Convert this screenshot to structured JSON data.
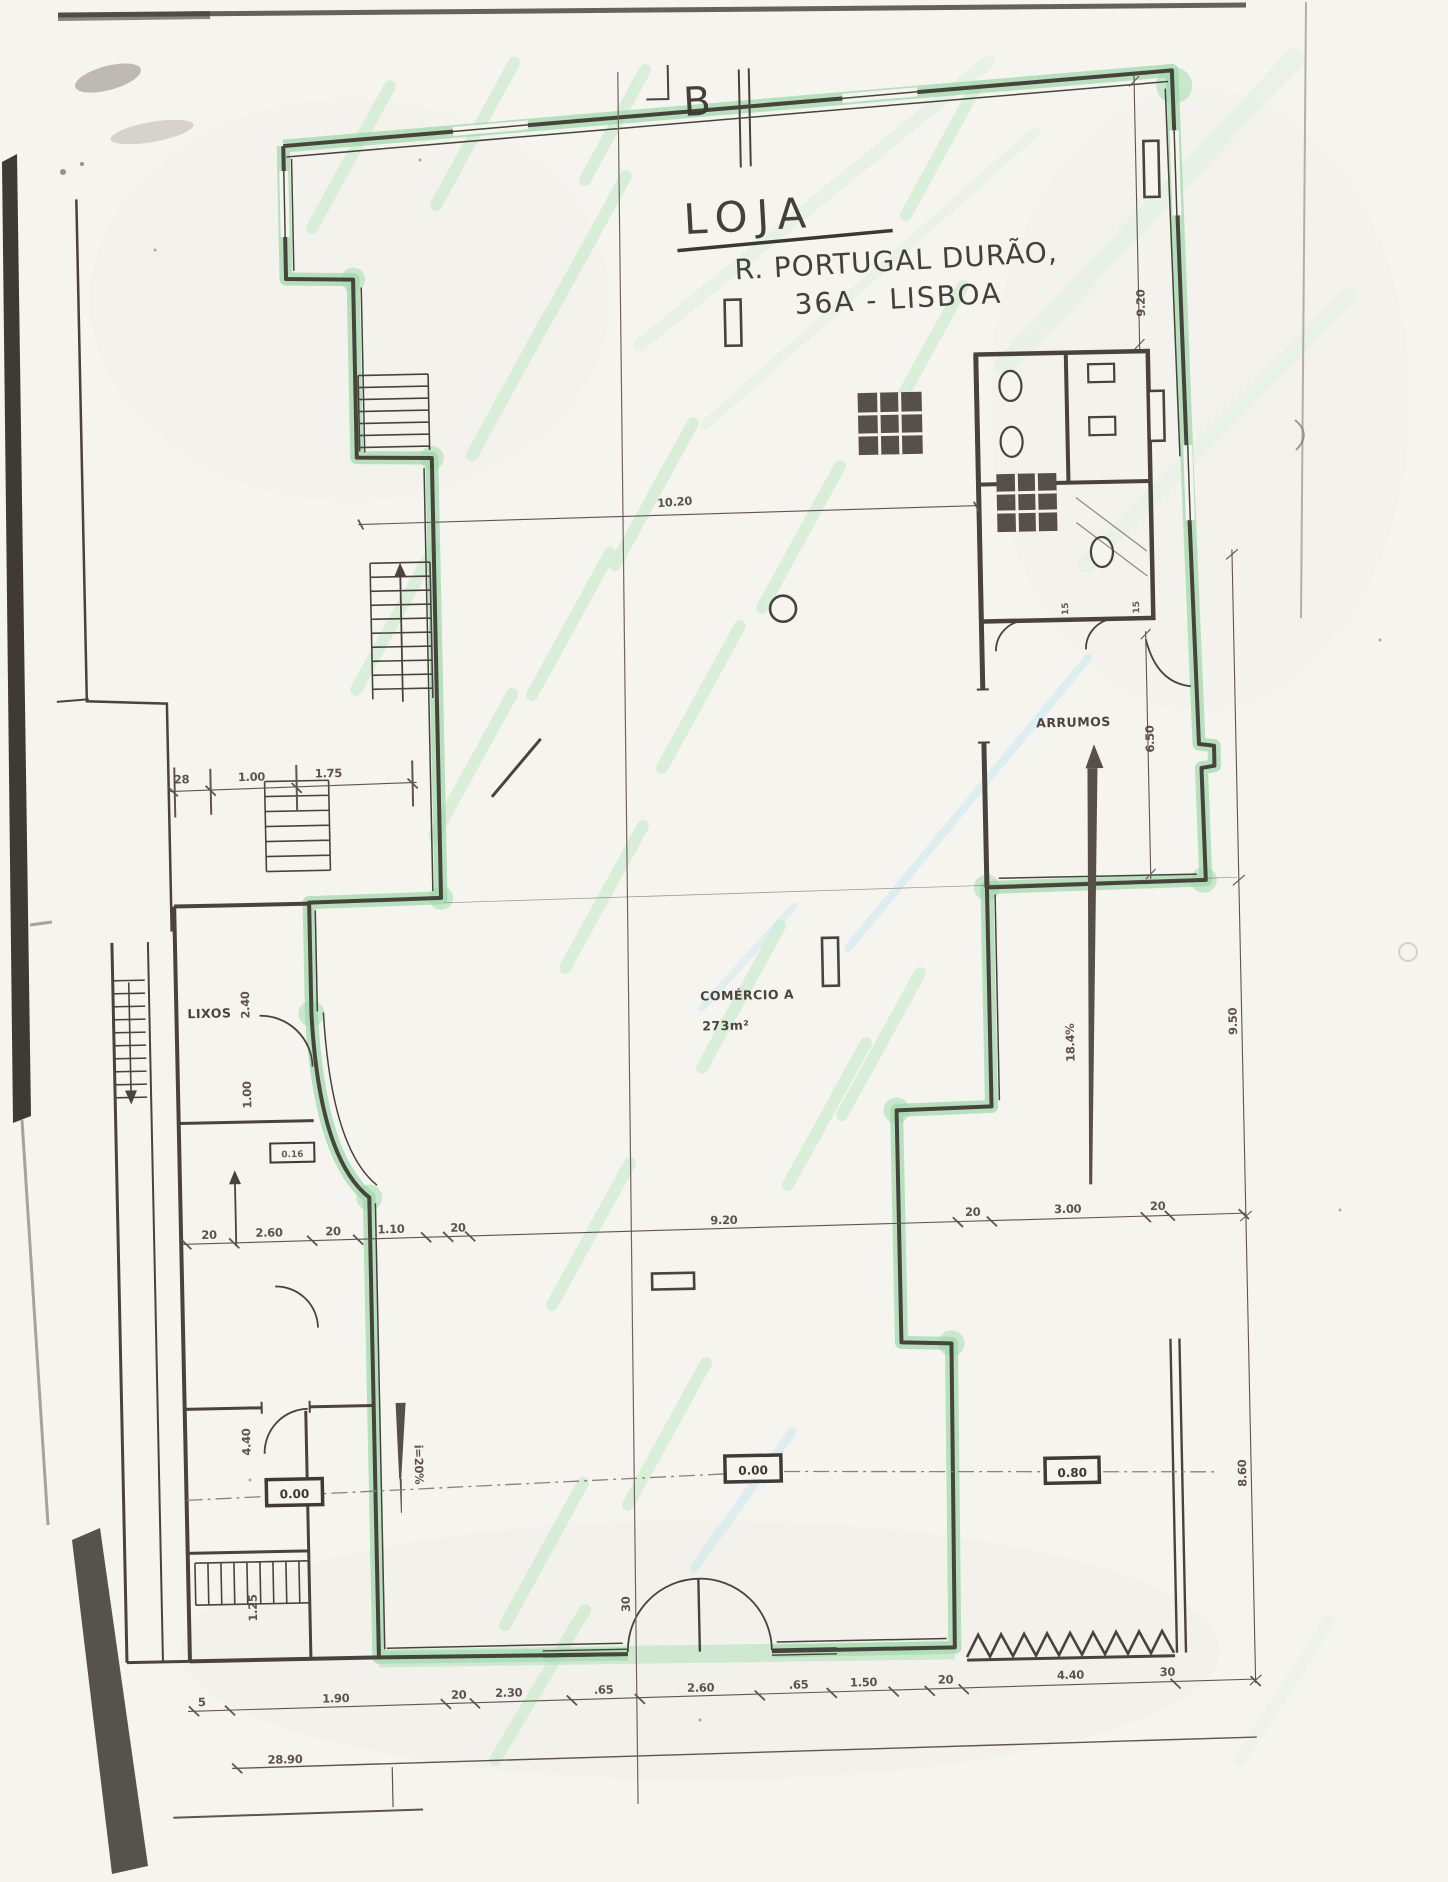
{
  "page": {
    "background": "#f6f4ef",
    "ink": "#4a443e",
    "highlight_green": "#9ad9a8"
  },
  "handwriting": {
    "section_letter": "B",
    "title": "LOJA",
    "address_line1": "R. PORTUGAL DURÃO,",
    "address_line2": "36A - LISBOA"
  },
  "rooms": {
    "storage": "ARRUMOS",
    "trash": "LIXOS",
    "commerce_title": "COMÉRCIO A",
    "commerce_area": "273m²"
  },
  "levels": {
    "left": "0.00",
    "center": "0.00",
    "right": "0.80"
  },
  "slopes": {
    "right_ramp": "18.4%",
    "entrance_ramp": "i=20%"
  },
  "dims": {
    "top_width": "10.20",
    "right_top": "9.20",
    "storage_height": "6.50",
    "toilets": [
      "15",
      "15"
    ],
    "far_right": [
      "9.50",
      "8.60"
    ],
    "left_row": [
      "28",
      "1.00",
      "1.75"
    ],
    "trash_column": [
      "2.40",
      "1.00"
    ],
    "left_column": [
      "4.40",
      "1.25"
    ],
    "door_width": "30",
    "small_box": "0.16",
    "mid_row": [
      "20",
      "2.60",
      "20",
      "1.10",
      "20",
      "9.20",
      "20",
      "3.00",
      "20"
    ],
    "bottom_row": [
      "5",
      "1.90",
      "20",
      "2.30",
      ".65",
      "2.60",
      ".65",
      "1.50",
      "20",
      "4.40",
      "30"
    ],
    "overall_width": "28.90"
  }
}
